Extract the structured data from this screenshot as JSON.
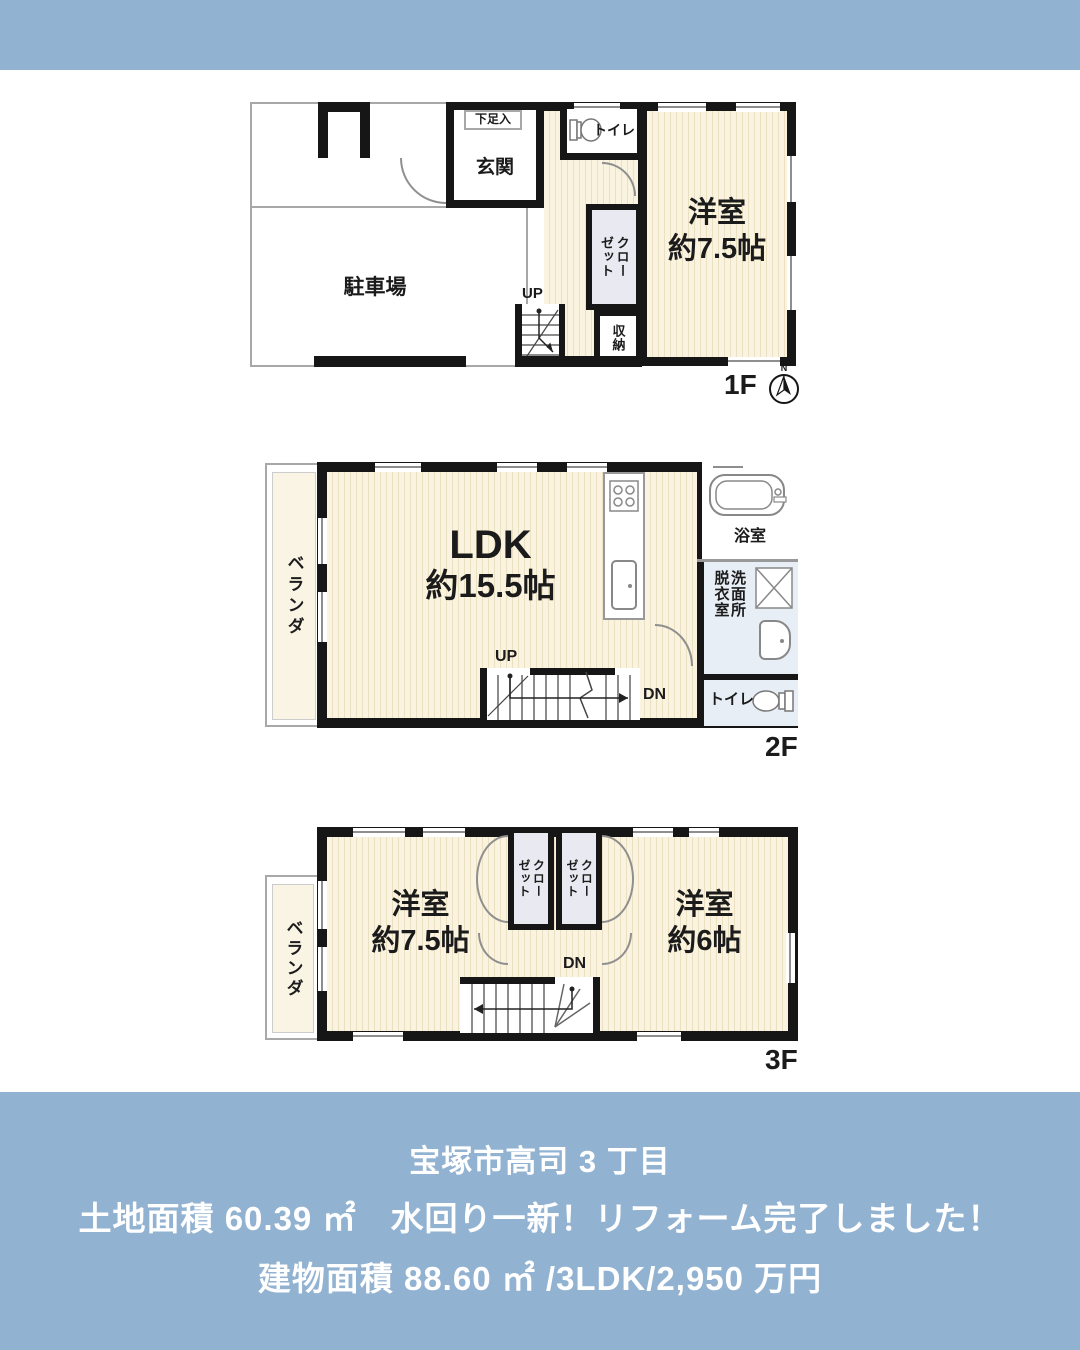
{
  "colors": {
    "band_blue": "#92b2d1",
    "wall_black": "#161616",
    "floor_cream": "#faf3df",
    "closet_fill": "#e9e9f2",
    "wet_room_fill": "#e7eef5",
    "footer_text": "#ffffff"
  },
  "floor1": {
    "floor_label": "1F",
    "parking": "駐車場",
    "genkan": "玄関",
    "shoe_box": "下足入",
    "toilet": "トイレ",
    "closet": "クローゼット",
    "storage": "収納",
    "stairs_up": "UP",
    "room_name": "洋室",
    "room_size": "約7.5帖",
    "compass_north": "N"
  },
  "floor2": {
    "floor_label": "2F",
    "veranda": "ベランダ",
    "ldk_name": "LDK",
    "ldk_size": "約15.5帖",
    "bath": "浴室",
    "dressing_room": "脱衣室",
    "washroom": "洗面所",
    "toilet": "トイレ",
    "stairs_up": "UP",
    "stairs_down": "DN"
  },
  "floor3": {
    "floor_label": "3F",
    "veranda": "ベランダ",
    "room_left_name": "洋室",
    "room_left_size": "約7.5帖",
    "closet_left": "クローゼット",
    "closet_right": "クローゼット",
    "room_right_name": "洋室",
    "room_right_size": "約6帖",
    "stairs_down": "DN"
  },
  "footer": {
    "line1": "宝塚市高司 3 丁目",
    "line2": "土地面積 60.39 ㎡　水回り一新！リフォーム完了しました！",
    "line3": "建物面積 88.60 ㎡ /3LDK/2,950 万円"
  }
}
